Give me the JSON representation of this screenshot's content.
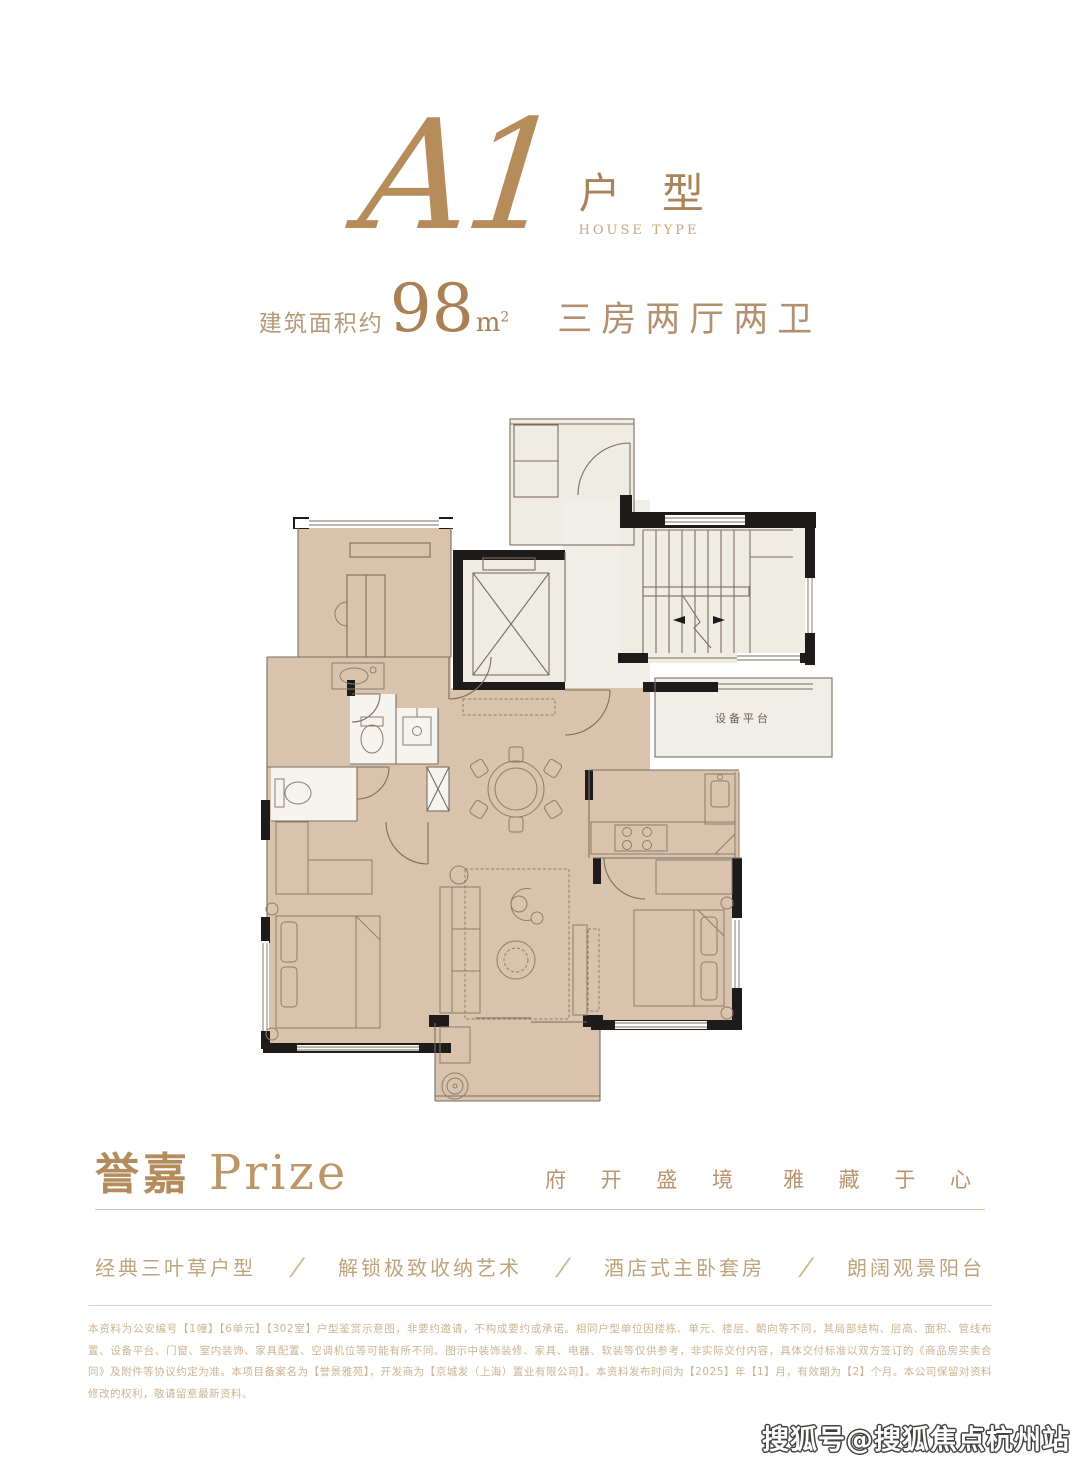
{
  "header": {
    "unit_script": "A1",
    "unit_cn": "户 型",
    "unit_en": "HOUSE TYPE"
  },
  "area": {
    "prefix": "建筑面积约",
    "value": "98",
    "unit": "m",
    "unit_sup": "2",
    "rooms": "三房两厅两卫"
  },
  "floorplan": {
    "equipment_label": "设备平台"
  },
  "brand": {
    "name_cn": "誉嘉",
    "name_en": "Prize",
    "tagline_a": "府 开 盛 境",
    "tagline_b": "雅 藏 于 心"
  },
  "features": {
    "separator": "/",
    "items": [
      "经典三叶草户型",
      "解锁极致收纳艺术",
      "酒店式主卧套房",
      "朗阔观景阳台"
    ]
  },
  "disclaimer": {
    "text": "本资料为公安编号【1幢】【6单元】【302室】户型鉴赏示意图，非要约邀请，不构成要约或承诺。相同户型单位因楼栋、单元、楼层、朝向等不同，其局部结构、层高、面积、管线布置、设备平台、门窗、室内装饰、家具配置、空调机位等可能有所不同。图示中装饰装修、家具、电器、软装等仅供参考，非实际交付内容，具体交付标准以双方签订的《商品房买卖合同》及附件等协议约定为准。本项目备案名为【誉景雅苑】，开发商为【京城发（上海）置业有限公司】。本资料发布时间为【2025】年【1】月，有效期为【2】个月。本公司保留对资料修改的权利，敬请留意最新资料。"
  },
  "watermark": {
    "text": "搜狐号@搜狐焦点杭州站"
  },
  "colors": {
    "accent": "#b08a5e",
    "accent_dark": "#a98154",
    "accent_light": "#c9ae85",
    "room_fill": "#d9c3ad",
    "service_fill": "#efece4",
    "wall": "#1e1c1a",
    "line": "#7c6d5e",
    "divider": "#dcc6a8",
    "fineprint": "#ccb392"
  }
}
